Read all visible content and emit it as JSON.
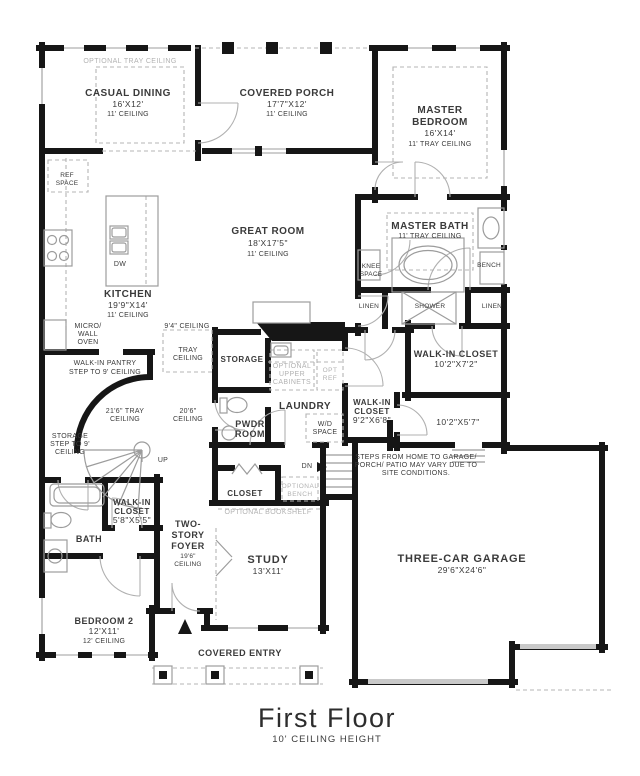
{
  "colors": {
    "wall": "#161616",
    "label": "#3a3a3a",
    "muted_option": "#b2b2b2",
    "fixture": "#9c9c9c",
    "background": "#ffffff"
  },
  "plan": {
    "floor_title": "First Floor",
    "floor_subtitle": "10' CEILING HEIGHT"
  },
  "labels": {
    "optional_tray_ceiling": "OPTIONAL TRAY CEILING",
    "casual_dining": [
      "CASUAL DINING",
      "16'X12'",
      "11' CEILING"
    ],
    "covered_porch": [
      "COVERED PORCH",
      "17'7\"X12'",
      "11' CEILING"
    ],
    "master_bedroom": [
      "MASTER",
      "BEDROOM",
      "16'X14'",
      "11' TRAY CEILING"
    ],
    "great_room": [
      "GREAT ROOM",
      "18'X17'5\"",
      "11' CEILING"
    ],
    "kitchen": [
      "KITCHEN",
      "19'9\"X14'",
      "11' CEILING"
    ],
    "ref_space": [
      "REF",
      "SPACE"
    ],
    "dw": "DW",
    "micro_wall_oven": [
      "MICRO/",
      "WALL",
      "OVEN"
    ],
    "walk_in_pantry": [
      "WALK-IN PANTRY",
      "STEP TO 9' CEILING"
    ],
    "ceiling_94": "9'4\" CEILING",
    "tray_ceiling": [
      "TRAY",
      "CEILING"
    ],
    "tray_216": [
      "21'6\" TRAY",
      "CEILING"
    ],
    "ceiling_206": [
      "20'6\"",
      "CEILING"
    ],
    "storage_stairs": [
      "STORAGE",
      "STEP TO 9'",
      "CEILING"
    ],
    "up": "UP",
    "storage": "STORAGE",
    "optional_upper_cabinets": [
      "OPTIONAL",
      "UPPER",
      "CABINETS"
    ],
    "opt_ref": [
      "OPT",
      "REF"
    ],
    "laundry": "LAUNDRY",
    "wd_space": [
      "W/D",
      "SPACE"
    ],
    "pwdr_room": [
      "PWDR",
      "ROOM"
    ],
    "master_bath": [
      "MASTER BATH",
      "11' TRAY CEILING"
    ],
    "knee_space": [
      "KNEE",
      "SPACE"
    ],
    "bench": "BENCH",
    "linen_left": "LINEN",
    "shower": "SHOWER",
    "linen_right": "LINEN",
    "wic_master": [
      "WALK-IN CLOSET",
      "10'2\"X7'2\""
    ],
    "wic_hall": [
      "WALK-IN",
      "CLOSET",
      "9'2\"X6'8\""
    ],
    "mud_hall_dims": "10'2\"X5'7\"",
    "steps_note": [
      "STEPS FROM HOME TO GARAGE/",
      "PORCH/ PATIO MAY VARY DUE TO",
      "SITE CONDITIONS."
    ],
    "garage": [
      "THREE-CAR GARAGE",
      "29'6\"X24'6\""
    ],
    "dn": "DN",
    "closet": "CLOSET",
    "optional_bench": [
      "OPTIONAL",
      "BENCH"
    ],
    "optional_bookshelf": "OPTIONAL BOOKSHELF",
    "study": [
      "STUDY",
      "13'X11'"
    ],
    "foyer": [
      "TWO-",
      "STORY",
      "FOYER",
      "19'6\"",
      "CEILING"
    ],
    "wic_bed2": [
      "WALK-IN",
      "CLOSET",
      "5'8\"X5'5\""
    ],
    "bath2": "BATH",
    "bedroom2": [
      "BEDROOM 2",
      "12'X11'",
      "12' CEILING"
    ],
    "covered_entry": "COVERED ENTRY"
  }
}
